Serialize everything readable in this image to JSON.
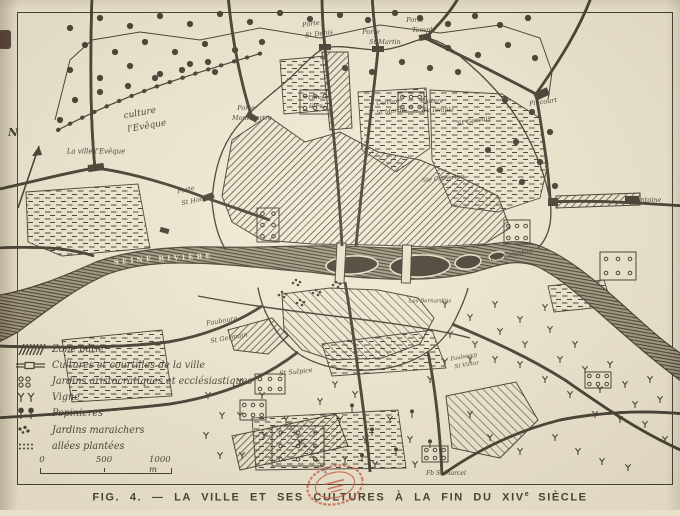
{
  "colors": {
    "paper": "#e8e0c9",
    "ink": "#332d22",
    "stamp_red": "#c04a38"
  },
  "figure": {
    "caption_main": "FIG. 4. — LA VILLE ET SES CULTURES À LA FIN DU XIV",
    "caption_sup": "e",
    "caption_tail": " SIÈCLE"
  },
  "compass": {
    "label": "N"
  },
  "legend": {
    "items": [
      {
        "symbol": "zone-batie",
        "label": "Zone bâtie"
      },
      {
        "symbol": "cultures",
        "label": "Cultures et courtilles de la ville"
      },
      {
        "symbol": "jardins-aristo",
        "label": "Jardins aristocratiques et ecclésiastiques"
      },
      {
        "symbol": "vigne",
        "label": "Vigne"
      },
      {
        "symbol": "pepinieres",
        "label": "Pepinieres"
      },
      {
        "symbol": "maraichers",
        "label": "Jardins maraichers"
      },
      {
        "symbol": "allees",
        "label": "allées plantées"
      }
    ],
    "scale_ticks": [
      "0",
      "500",
      "1000 m"
    ]
  },
  "map_labels": [
    {
      "text": "culture",
      "x": 140,
      "y": 114,
      "size": 9,
      "rot": -10
    },
    {
      "text": "l'Evêque",
      "x": 147,
      "y": 127,
      "size": 9,
      "rot": -10
    },
    {
      "text": "La ville l'Evêque",
      "x": 96,
      "y": 152,
      "size": 7,
      "rot": 0
    },
    {
      "text": "Porte",
      "x": 186,
      "y": 190,
      "size": 6.5,
      "rot": -12
    },
    {
      "text": "St Honoré",
      "x": 198,
      "y": 200,
      "size": 6.5,
      "rot": -12
    },
    {
      "text": "Porte",
      "x": 246,
      "y": 108,
      "size": 6.5,
      "rot": 0
    },
    {
      "text": "Montmartre",
      "x": 252,
      "y": 118,
      "size": 6.5,
      "rot": 0
    },
    {
      "text": "Filles",
      "x": 316,
      "y": 99,
      "size": 5.8,
      "rot": 0
    },
    {
      "text": "Dieu",
      "x": 316,
      "y": 107,
      "size": 5.8,
      "rot": 0
    },
    {
      "text": "Porte",
      "x": 311,
      "y": 24,
      "size": 6.5,
      "rot": -8
    },
    {
      "text": "St Denis",
      "x": 319,
      "y": 34,
      "size": 6.5,
      "rot": -8
    },
    {
      "text": "Porte",
      "x": 371,
      "y": 32,
      "size": 6.5,
      "rot": 0
    },
    {
      "text": "St Martin",
      "x": 385,
      "y": 42,
      "size": 6.5,
      "rot": 0
    },
    {
      "text": "Porte",
      "x": 415,
      "y": 20,
      "size": 6.5,
      "rot": 0
    },
    {
      "text": "Temple",
      "x": 424,
      "y": 30,
      "size": 6.5,
      "rot": 0
    },
    {
      "text": "Culture",
      "x": 388,
      "y": 103,
      "size": 6,
      "rot": -6
    },
    {
      "text": "St Martin",
      "x": 391,
      "y": 112,
      "size": 6,
      "rot": -6
    },
    {
      "text": "Culture",
      "x": 432,
      "y": 102,
      "size": 6,
      "rot": 0
    },
    {
      "text": "du Temple",
      "x": 438,
      "y": 111,
      "size": 6,
      "rot": 0
    },
    {
      "text": "St Gervais",
      "x": 474,
      "y": 121,
      "size": 6.5,
      "rot": -10
    },
    {
      "text": "Ste Catherine",
      "x": 443,
      "y": 179,
      "size": 6,
      "rot": -6
    },
    {
      "text": "Pincourt",
      "x": 543,
      "y": 102,
      "size": 6.5,
      "rot": -8
    },
    {
      "text": "St Antoine",
      "x": 644,
      "y": 200,
      "size": 6.5,
      "rot": 0
    },
    {
      "text": "SEINE",
      "x": 134,
      "y": 260,
      "size": 7,
      "rot": -6,
      "class": "river"
    },
    {
      "text": "RIVIÈRE",
      "x": 186,
      "y": 257,
      "size": 7,
      "rot": -3,
      "class": "river"
    },
    {
      "text": "Les Celestins",
      "x": 512,
      "y": 255,
      "size": 6.5,
      "rot": -12
    },
    {
      "text": "Les Bernardins",
      "x": 430,
      "y": 302,
      "size": 5.5,
      "rot": 0
    },
    {
      "text": "Faubourg",
      "x": 222,
      "y": 321,
      "size": 6.5,
      "rot": -10
    },
    {
      "text": "St Germain",
      "x": 229,
      "y": 338,
      "size": 6.5,
      "rot": -10
    },
    {
      "text": "St Sulpice",
      "x": 296,
      "y": 372,
      "size": 6.5,
      "rot": -6
    },
    {
      "text": "Enclos des Chartreux",
      "x": 306,
      "y": 448,
      "size": 6,
      "rot": 52
    },
    {
      "text": "Faubourg",
      "x": 464,
      "y": 358,
      "size": 5.5,
      "rot": -10
    },
    {
      "text": "St Victor",
      "x": 467,
      "y": 366,
      "size": 5.5,
      "rot": -10
    },
    {
      "text": "Fb St Marcel",
      "x": 446,
      "y": 474,
      "size": 6,
      "rot": 0
    }
  ]
}
